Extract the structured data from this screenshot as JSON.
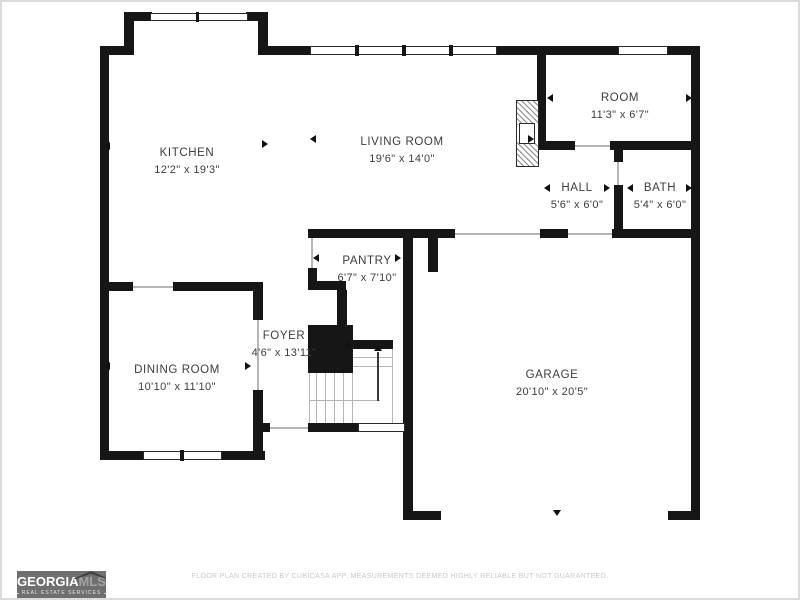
{
  "rooms": {
    "kitchen": {
      "name": "KITCHEN",
      "dimensions": "12'2\" x 19'3\""
    },
    "living_room": {
      "name": "LIVING ROOM",
      "dimensions": "19'6\" x 14'0\""
    },
    "room": {
      "name": "ROOM",
      "dimensions": "11'3\" x 6'7\""
    },
    "hall": {
      "name": "HALL",
      "dimensions": "5'6\" x 6'0\""
    },
    "bath": {
      "name": "BATH",
      "dimensions": "5'4\" x 6'0\""
    },
    "pantry": {
      "name": "PANTRY",
      "dimensions": "6'7\" x 7'10\""
    },
    "foyer": {
      "name": "FOYER",
      "dimensions": "4'6\" x 13'11\""
    },
    "dining_room": {
      "name": "DINING ROOM",
      "dimensions": "10'10\" x 11'10\""
    },
    "garage": {
      "name": "GARAGE",
      "dimensions": "20'10\" x 20'5\""
    }
  },
  "branding": {
    "logo_part_bold": "GEORGIA",
    "logo_part_light": "MLS",
    "tagline": "REAL ESTATE SERVICES"
  },
  "footer": {
    "disclaimer": "FLOOR PLAN CREATED BY CUBICASA APP. MEASUREMENTS DEEMED HIGHLY RELIABLE BUT NOT GUARANTEED."
  },
  "colors": {
    "wall": "#161616",
    "label_text": "#3d3d3d",
    "logo_background": "#6f6f6f",
    "disclaimer_text": "#c8c8c8"
  }
}
